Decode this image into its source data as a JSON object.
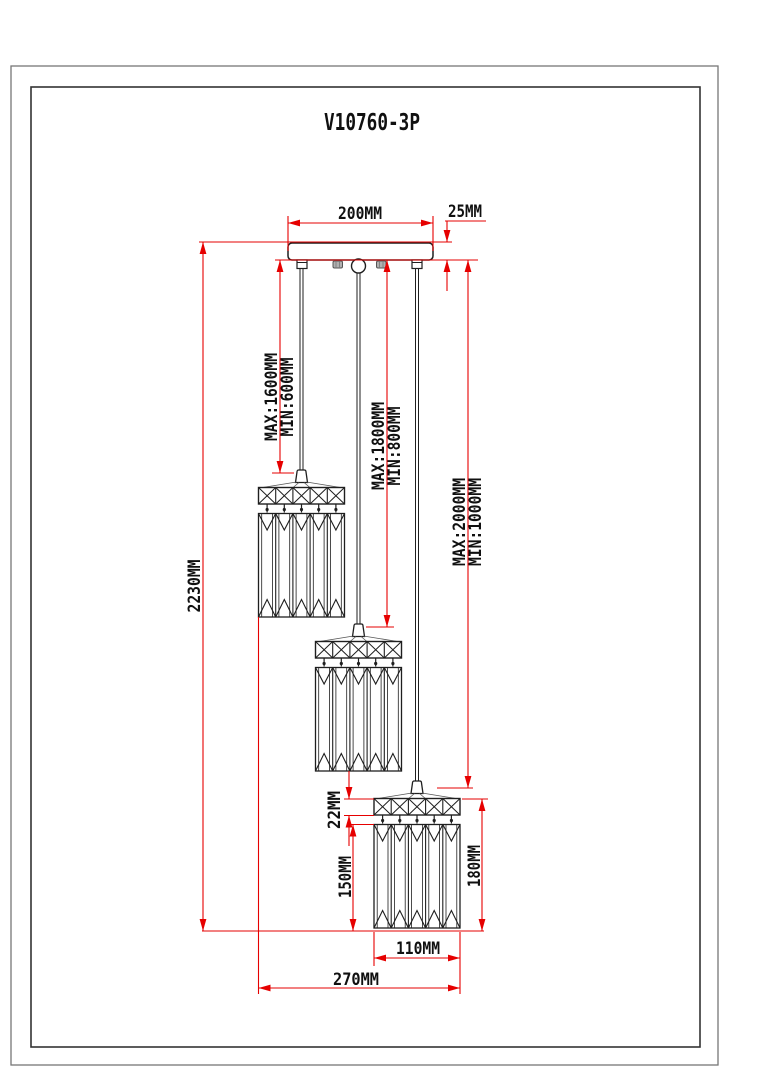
{
  "title": "V10760-3P",
  "colors": {
    "dimension_red": "#e60000",
    "drawing_black": "#1f1f1f",
    "background": "#ffffff"
  },
  "dimensions": {
    "canopy_width": "200MM",
    "canopy_thickness": "25MM",
    "overall_height": "2230MM",
    "pendant1": {
      "max": "MAX:1600MM",
      "min": "MIN:600MM"
    },
    "pendant2": {
      "max": "MAX:1800MM",
      "min": "MIN:800MM"
    },
    "pendant3": {
      "max": "MAX:2000MM",
      "min": "MIN:1000MM"
    },
    "shade_band_height": "22MM",
    "shade_prism_height": "150MM",
    "shade_total_height": "180MM",
    "shade_width": "110MM",
    "cluster_spread": "270MM"
  }
}
